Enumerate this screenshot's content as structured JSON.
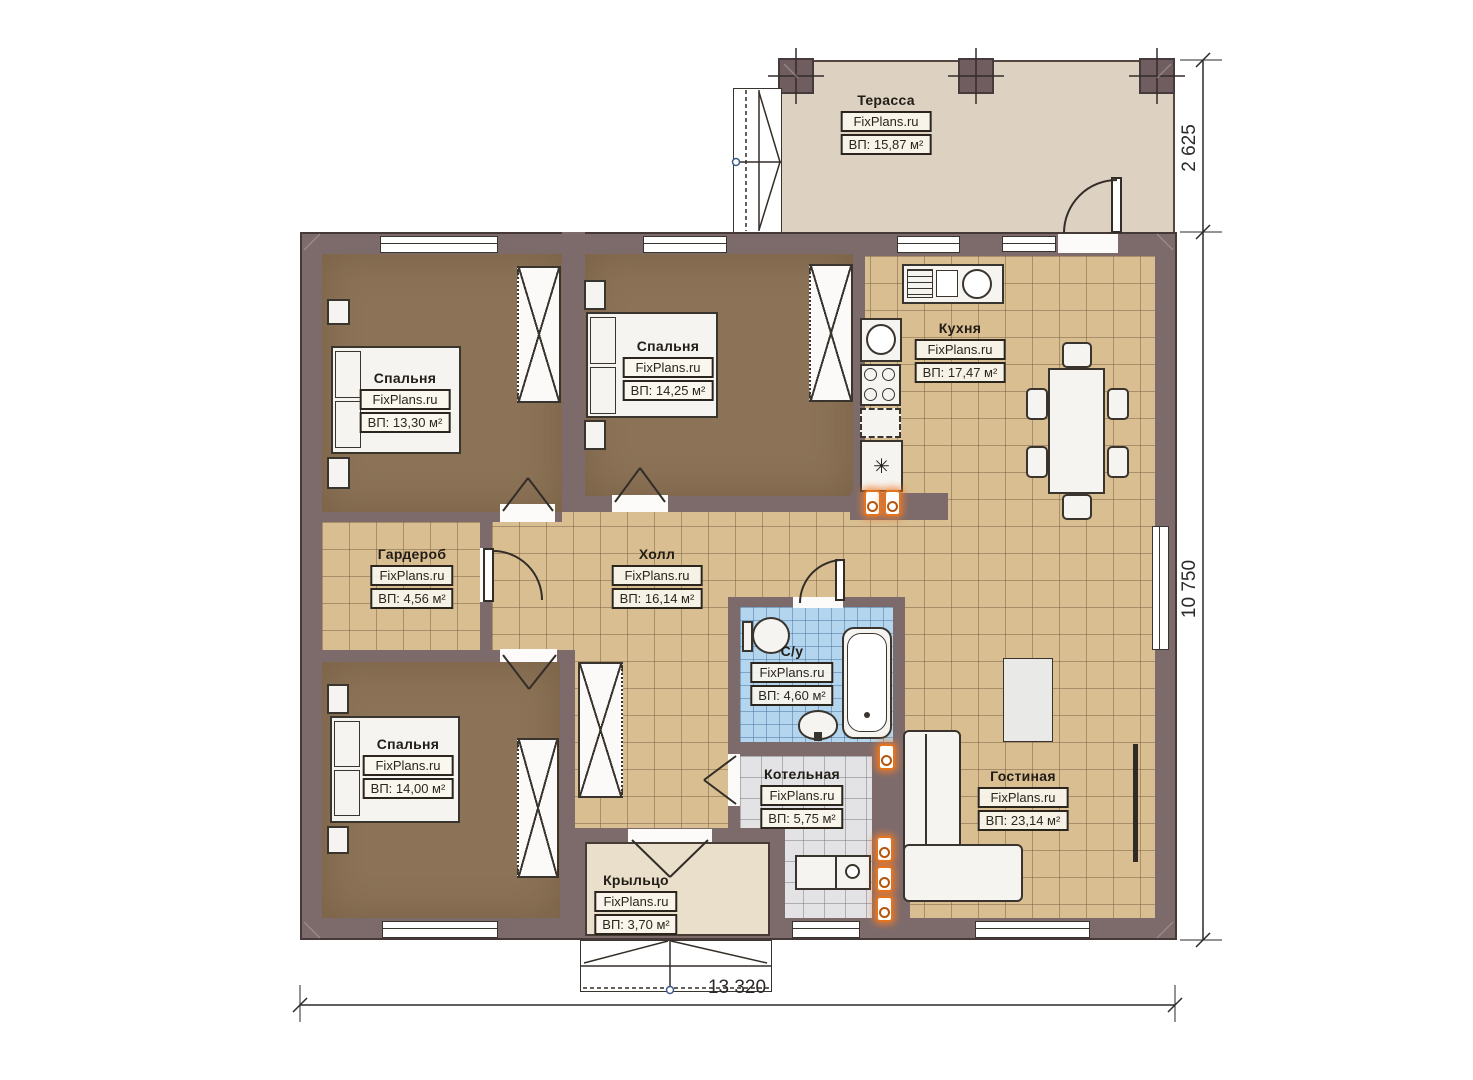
{
  "plan": {
    "watermark": "FixPlans.ru",
    "rooms": [
      {
        "id": "terrace",
        "name": "Терасса",
        "area": "ВП: 15,87 м²"
      },
      {
        "id": "bedroom1",
        "name": "Спальня",
        "area": "ВП: 13,30 м²"
      },
      {
        "id": "bedroom2",
        "name": "Спальня",
        "area": "ВП: 14,25 м²"
      },
      {
        "id": "kitchen",
        "name": "Кухня",
        "area": "ВП: 17,47 м²"
      },
      {
        "id": "wardrobe",
        "name": "Гардероб",
        "area": "ВП: 4,56 м²"
      },
      {
        "id": "hall",
        "name": "Холл",
        "area": "ВП: 16,14 м²"
      },
      {
        "id": "bathroom",
        "name": "С/у",
        "area": "ВП: 4,60 м²"
      },
      {
        "id": "boiler",
        "name": "Котельная",
        "area": "ВП: 5,75 м²"
      },
      {
        "id": "living",
        "name": "Гостиная",
        "area": "ВП: 23,14 м²"
      },
      {
        "id": "bedroom3",
        "name": "Спальня",
        "area": "ВП: 14,00 м²"
      },
      {
        "id": "porch",
        "name": "Крыльцо",
        "area": "ВП: 3,70 м²"
      }
    ],
    "dimensions": {
      "terrace_depth": "2 625",
      "house_depth": "10 750",
      "house_width": "13 320"
    },
    "colors": {
      "wall": "#7d6b6c",
      "wall-dark": "#453a38",
      "bedfloor": "#8c7357",
      "tile": "#d9be92",
      "tileline": "rgba(110,85,55,0.45)",
      "bath": "#b3d6ee",
      "boilerfloor": "#e3e3e5",
      "terrace": "#ddd2c1",
      "porch": "#e9dfca",
      "valve": "#e2731f"
    }
  }
}
